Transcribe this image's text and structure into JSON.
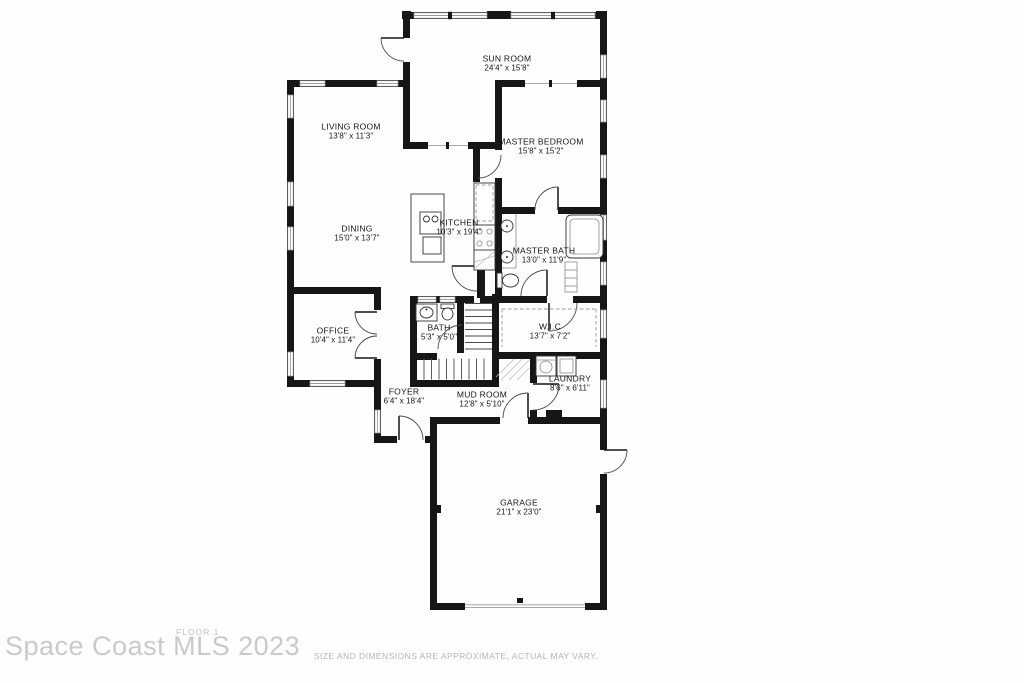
{
  "footer": {
    "watermark": "Space Coast MLS 2023",
    "floor_label": "FLOOR 1",
    "disclaimer": "SIZE AND DIMENSIONS ARE APPROXIMATE, ACTUAL MAY VARY."
  },
  "colors": {
    "wall": "#161616",
    "window_line": "#9c9c9c",
    "watermark_gray": "#cacaca",
    "disclaimer_gray": "#b5b5b5",
    "paper": "#fefefe"
  },
  "rooms": [
    {
      "id": "sun-room",
      "name": "SUN ROOM",
      "dims": "24'4\" x 15'8\""
    },
    {
      "id": "living-room",
      "name": "LIVING ROOM",
      "dims": "13'8\" x 11'3\""
    },
    {
      "id": "master-bedroom",
      "name": "MASTER BEDROOM",
      "dims": "15'8\" x 15'2\""
    },
    {
      "id": "dining",
      "name": "DINING",
      "dims": "15'0\" x 13'7\""
    },
    {
      "id": "kitchen",
      "name": "KITCHEN",
      "dims": "10'3\" x 19'4\""
    },
    {
      "id": "master-bath",
      "name": "MASTER BATH",
      "dims": "13'0\" x 11'9\""
    },
    {
      "id": "office",
      "name": "OFFICE",
      "dims": "10'4\" x 11'4\""
    },
    {
      "id": "bath",
      "name": "BATH",
      "dims": "5'3\" x 5'0\""
    },
    {
      "id": "wic",
      "name": "W.I.C",
      "dims": "13'7\" x 7'2\""
    },
    {
      "id": "foyer",
      "name": "FOYER",
      "dims": "6'4\" x 18'4\""
    },
    {
      "id": "mud-room",
      "name": "MUD ROOM",
      "dims": "12'8\" x 5'10\""
    },
    {
      "id": "laundry",
      "name": "LAUNDRY",
      "dims": "8'6\" x 6'11\""
    },
    {
      "id": "garage",
      "name": "GARAGE",
      "dims": "21'1\" x 23'0\""
    }
  ]
}
